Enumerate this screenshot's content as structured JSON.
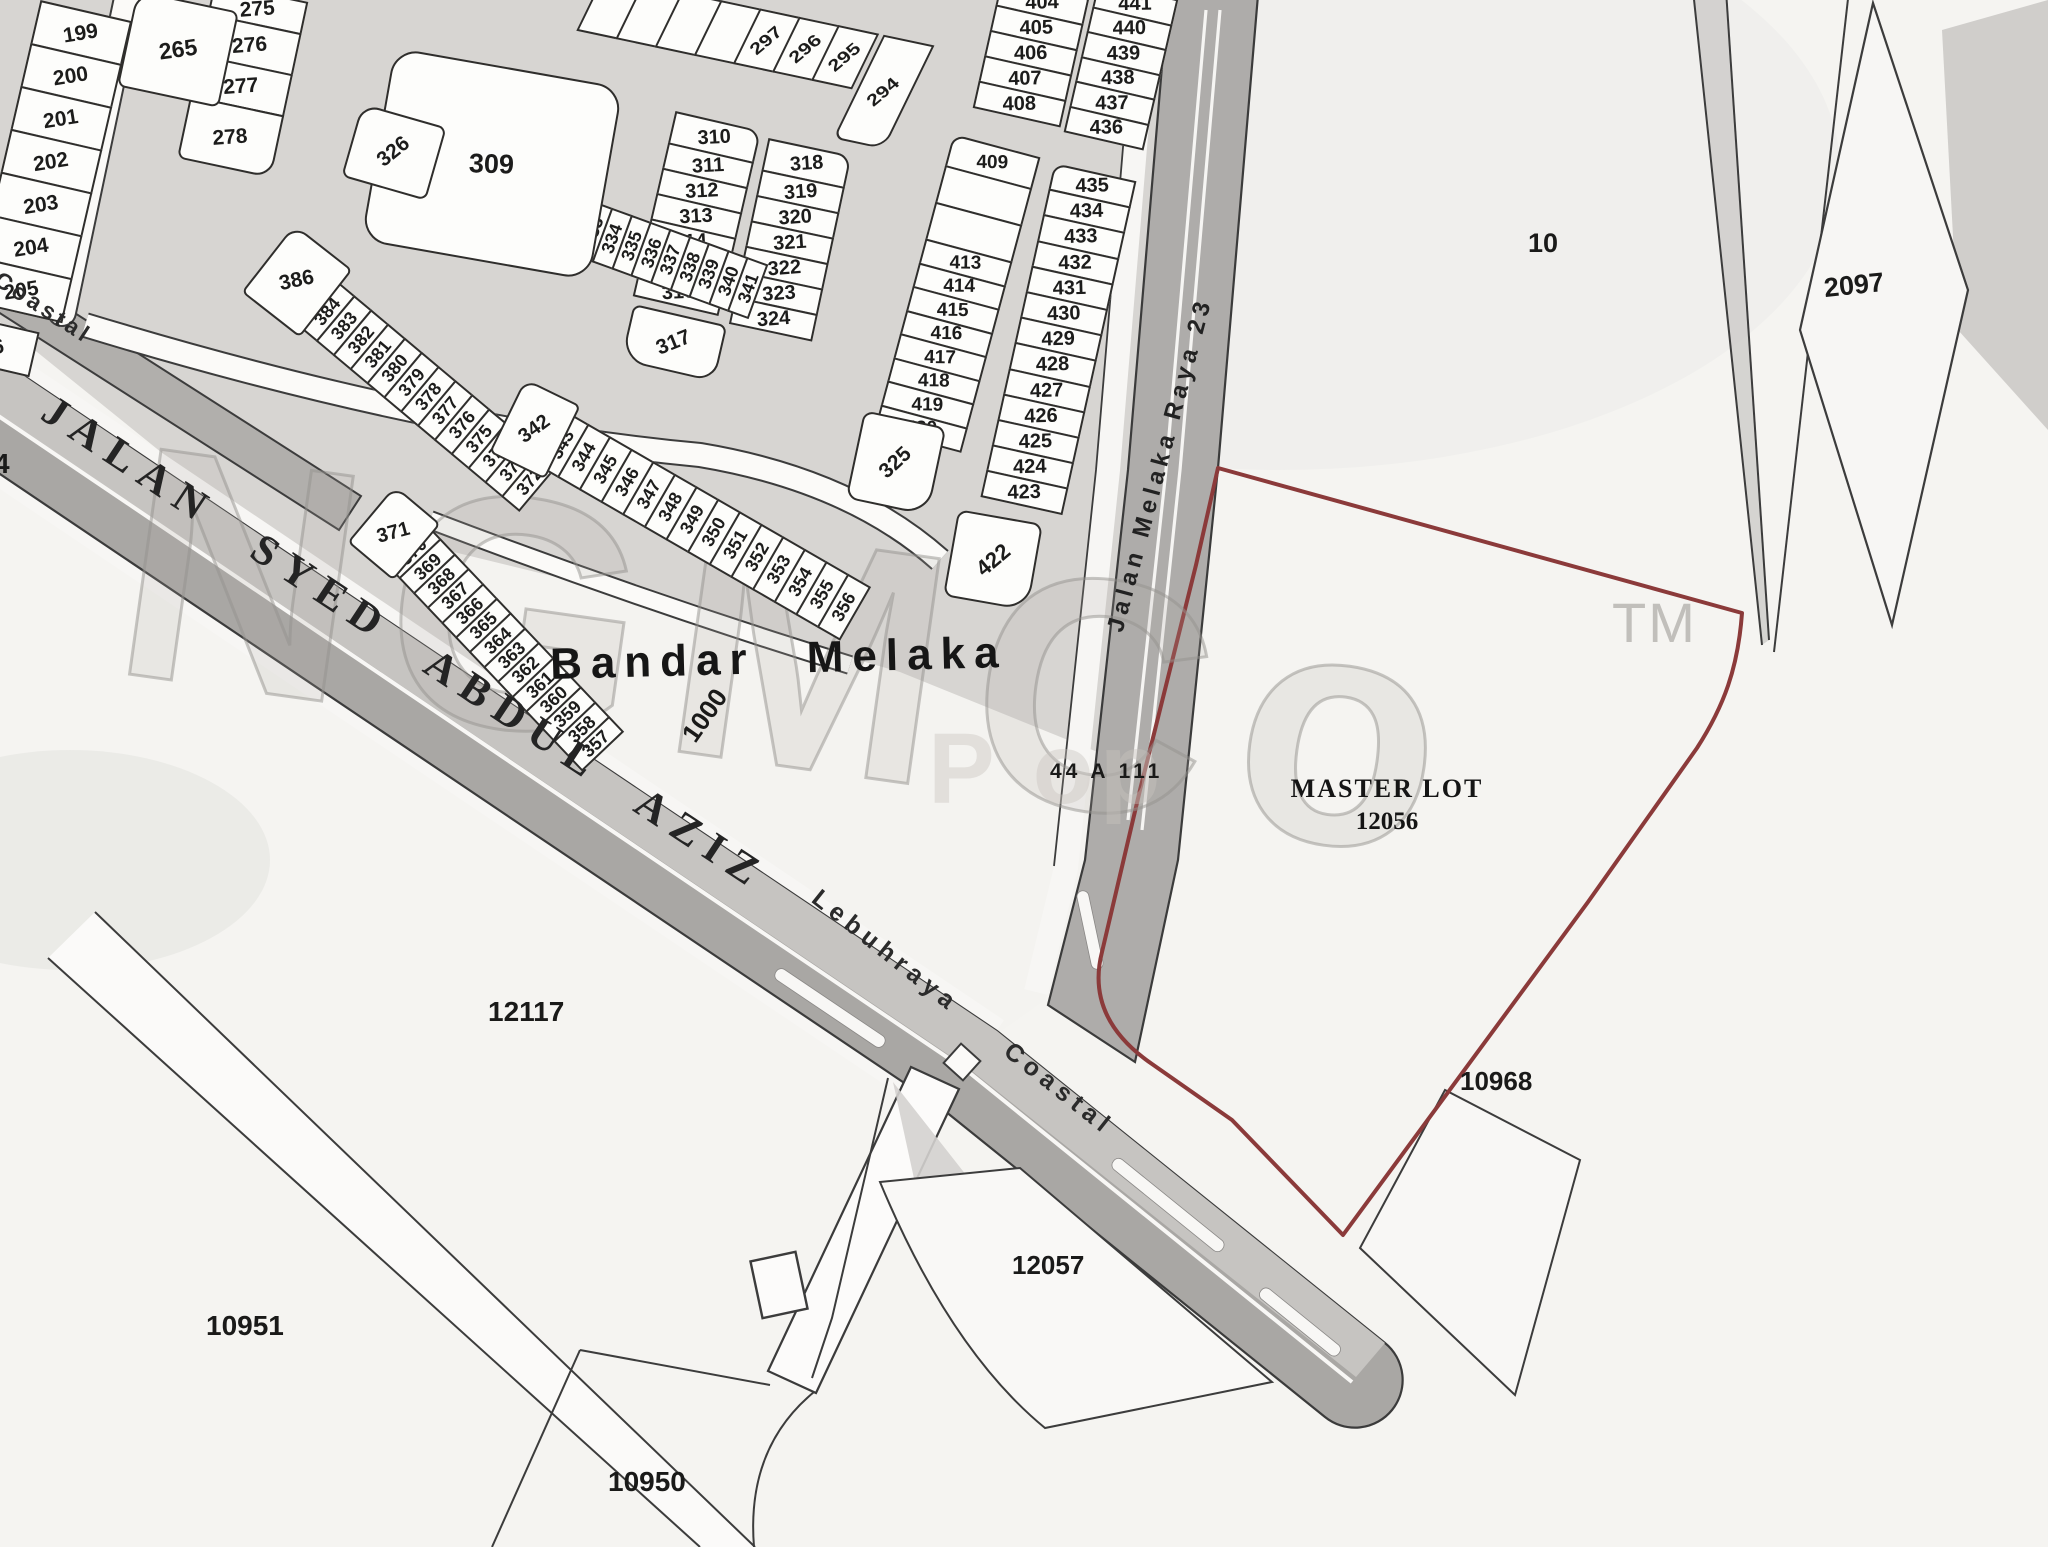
{
  "watermark": {
    "brand": "NGMCo",
    "tm": "TM",
    "sub": "P op"
  },
  "roads": {
    "jalan_syed": "JALAN SYED ABDUL AZIZ",
    "coastal_top": "Coastal",
    "lebuhraya": "Lebuhraya Coastal",
    "raya23": "Jalan Melaka Raya 23"
  },
  "labels": {
    "town": "Bandar Melaka",
    "master_line1": "MASTER LOT",
    "master_line2": "12056",
    "ref": "44 A 111"
  },
  "parcels": {
    "p265": "265",
    "p309": "309",
    "p317": "317",
    "p325": "325",
    "p326": "326",
    "p342": "342",
    "p371": "371",
    "p386": "386",
    "p422": "422",
    "p1000": "1000",
    "p10": "10",
    "p2097": "2097",
    "p10968": "10968",
    "p12057": "12057",
    "p12117": "12117",
    "p10951": "10951",
    "p10950": "10950",
    "p4": "4"
  },
  "groups": {
    "left_col": [
      "199",
      "200",
      "201",
      "202",
      "203",
      "204",
      "205",
      "6"
    ],
    "col_275": [
      "275",
      "276",
      "277",
      "278"
    ],
    "top_strip": [
      "",
      "",
      "",
      "",
      "297",
      "296",
      "295",
      "294"
    ],
    "col_310": [
      "310",
      "311",
      "312",
      "313",
      "314",
      "315",
      "316"
    ],
    "col_318": [
      "318",
      "319",
      "320",
      "321",
      "322",
      "323",
      "324"
    ],
    "col_404": [
      "404",
      "405",
      "406",
      "407",
      "408"
    ],
    "col_409": [
      "409",
      "",
      "",
      "413",
      "414",
      "415",
      "416",
      "417",
      "418",
      "419",
      "420"
    ],
    "col_436": [
      "441",
      "440",
      "439",
      "438",
      "437",
      "436"
    ],
    "col_425": [
      "435",
      "434",
      "433",
      "432",
      "431",
      "430",
      "429",
      "428",
      "427",
      "426",
      "425",
      "424",
      "423"
    ],
    "row_327": [
      "327",
      "328",
      "329",
      "330",
      "331",
      "332",
      "333",
      "334",
      "335",
      "336",
      "337",
      "338",
      "339",
      "340",
      "341"
    ],
    "row_385": [
      "385",
      "384",
      "383",
      "382",
      "381",
      "380",
      "379",
      "378",
      "377",
      "376",
      "375",
      "374",
      "373",
      "372"
    ],
    "row_343": [
      "343",
      "344",
      "345",
      "346",
      "347",
      "348",
      "349",
      "350",
      "351",
      "352",
      "353",
      "354",
      "355",
      "356"
    ],
    "row_370": [
      "370",
      "369",
      "368",
      "367",
      "366",
      "365",
      "364",
      "363",
      "362",
      "361",
      "360",
      "359",
      "358",
      "357"
    ]
  }
}
